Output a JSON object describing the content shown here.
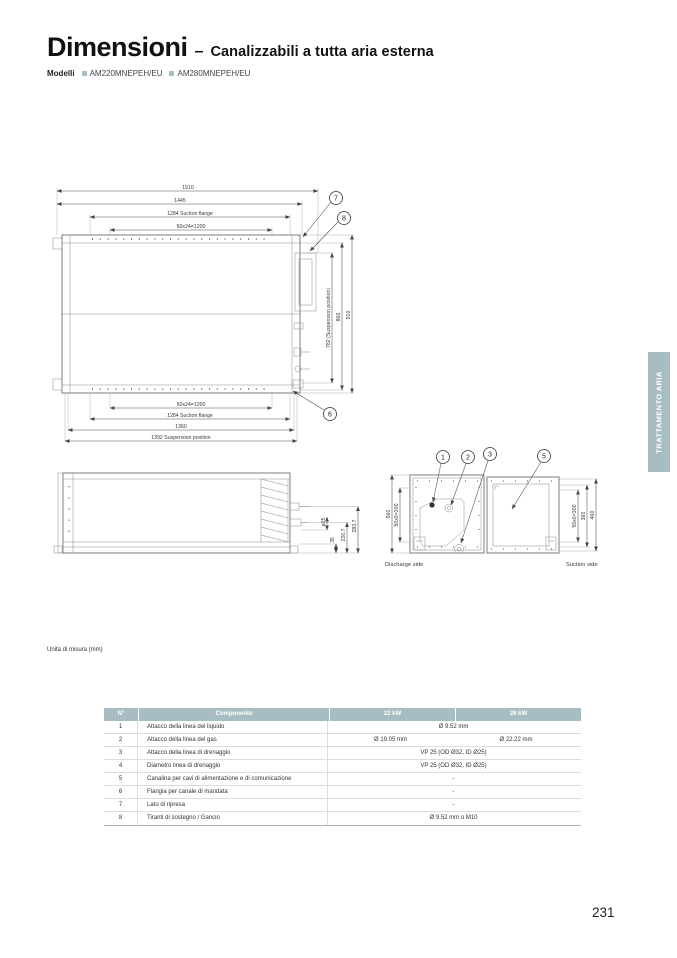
{
  "header": {
    "title": "Dimensioni",
    "separator": "–",
    "subtitle": "Canalizzabili a tutta aria esterna",
    "models_label": "Modelli",
    "models": [
      "AM220MNEPEH/EU",
      "AM280MNEPEH/EU"
    ]
  },
  "side_tab": {
    "label": "TRATTAMENTO ARIA"
  },
  "colors": {
    "accent": "#a7bcc3"
  },
  "top_view": {
    "dim_1510": "1510",
    "dim_1445": "1445",
    "dim_suction_top": "1284 Suction flange",
    "dim_bolt_top": "50x24=1200",
    "dim_bolt_bottom": "50x24=1200",
    "dim_suction_bottom": "1284 Suction flange",
    "dim_1360": "1360",
    "dim_suspension": "1392 Suspension position",
    "dim_782": "782 (Suspension position)",
    "dim_860": "860",
    "dim_910": "910",
    "callout_7": "7",
    "callout_8": "8",
    "callout_6": "6"
  },
  "side_view": {
    "dim_o25": "ø25",
    "dim_35": "35",
    "dim_2267": "226.7",
    "dim_2837": "283.7"
  },
  "end_view": {
    "callout_1": "1",
    "callout_2": "2",
    "callout_3": "3",
    "callout_5": "5",
    "dim_560": "560",
    "dim_discharge_bolt": "50x6=300",
    "dim_suction_bolt": "50x6=300",
    "dim_360": "360",
    "dim_460": "460",
    "discharge_label": "Discharge side",
    "suction_label": "Suction side"
  },
  "note": {
    "units": "Unità di misura (mm)"
  },
  "table": {
    "headers": [
      "N°",
      "Componente",
      "22 kW",
      "28 kW"
    ],
    "rows": [
      {
        "n": "1",
        "component": "Attacco della linea del liquido",
        "merged": true,
        "value": "Ø 9.52 mm"
      },
      {
        "n": "2",
        "component": "Attacco della linea del gas",
        "merged": false,
        "value_22": "Ø 19.05 mm",
        "value_28": "Ø 22.22 mm"
      },
      {
        "n": "3",
        "component": "Attacco della linea di drenaggio",
        "merged": true,
        "value": "VP 25 (OD Ø32, ID Ø25)"
      },
      {
        "n": "4",
        "component": "Diametro linea di drenaggio",
        "merged": true,
        "value": "VP 25 (OD Ø32, ID Ø25)"
      },
      {
        "n": "5",
        "component": "Canalina per cavi di alimentazione e di comunicazione",
        "merged": true,
        "value": "-"
      },
      {
        "n": "6",
        "component": "Flangia per canale di mandata",
        "merged": true,
        "value": "-"
      },
      {
        "n": "7",
        "component": "Lato di ripresa",
        "merged": true,
        "value": "-"
      },
      {
        "n": "8",
        "component": "Tiranti di sostegno / Gancio",
        "merged": true,
        "value": "Ø 9.52 mm o M10"
      }
    ]
  },
  "footer": {
    "page_number": "231"
  }
}
